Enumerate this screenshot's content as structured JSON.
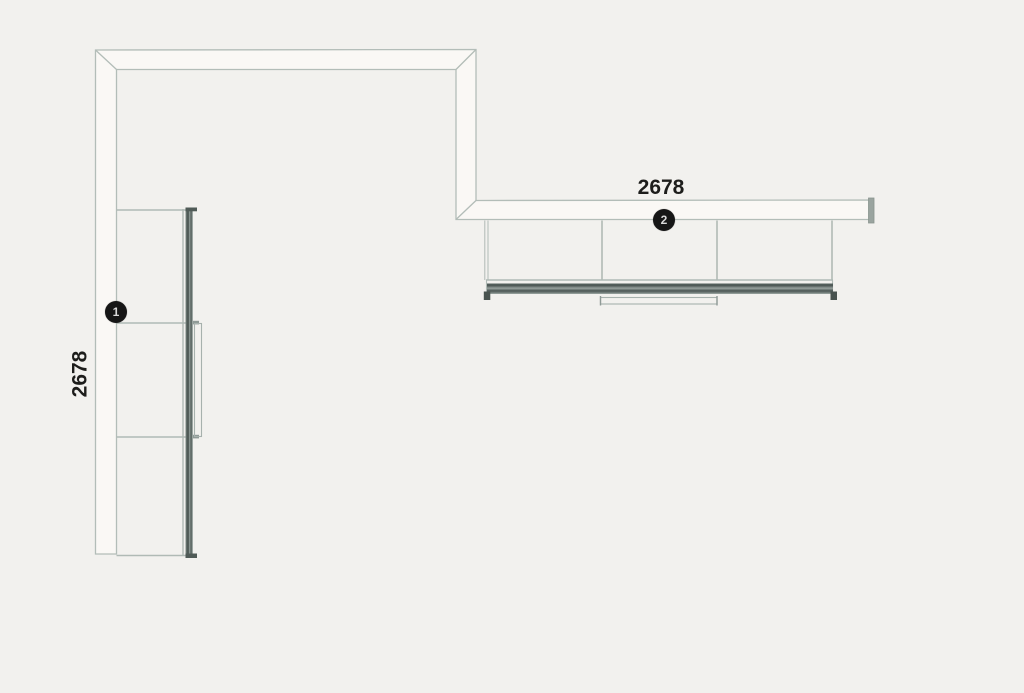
{
  "page": {
    "background_color": "#f2f1ee"
  },
  "drawing": {
    "type": "corner-wardrobe-plan-view",
    "sections": [
      {
        "marker": "1",
        "dimension": "2678",
        "orientation": "left-vertical-unit",
        "compartments": 3
      },
      {
        "marker": "2",
        "dimension": "2678",
        "orientation": "top-horizontal-unit",
        "compartments": 3
      }
    ],
    "colors": {
      "outline": "#b3bdb8",
      "shelf_line": "#b0bab5",
      "panel_fill": "#faf8f5",
      "rail_dark": "#4c5754",
      "end_cap": "#9aa49f",
      "marker_background": "#161616",
      "marker_text": "#d9d9d9",
      "dimension_text": "#1d1d1b"
    }
  }
}
